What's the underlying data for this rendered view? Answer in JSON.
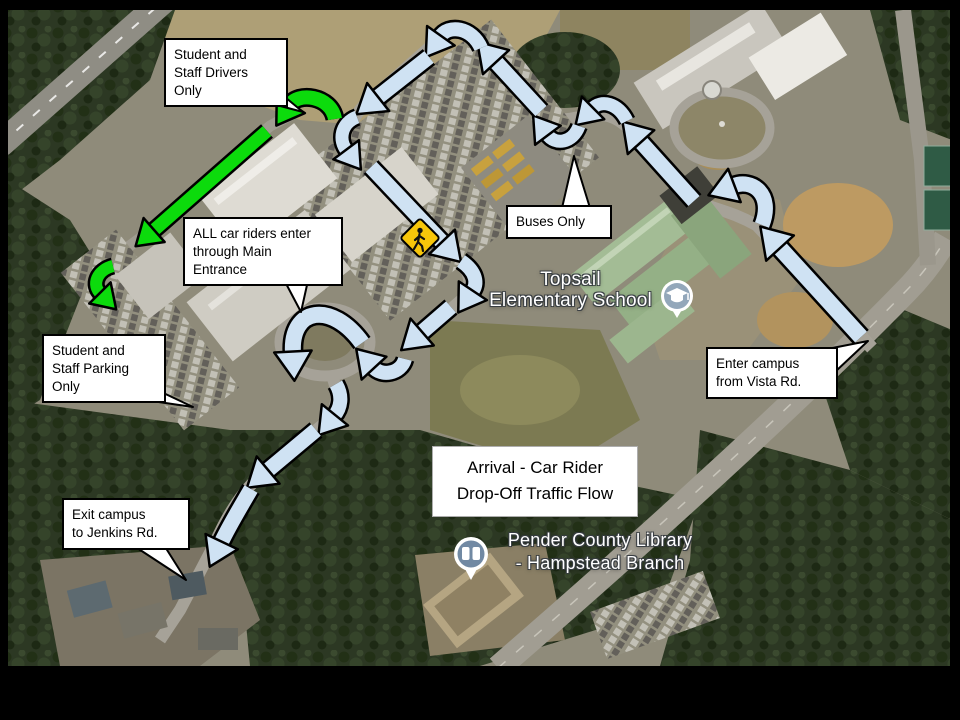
{
  "title": {
    "text": "Arrival - Car Rider\nDrop-Off Traffic Flow"
  },
  "callouts": {
    "drivers": {
      "text": "Student and\nStaff Drivers\nOnly"
    },
    "car_riders": {
      "text": "ALL car riders enter\nthrough Main\nEntrance"
    },
    "buses": {
      "text": "Buses Only"
    },
    "parking": {
      "text": "Student and\nStaff Parking\nOnly"
    },
    "enter": {
      "text": "Enter campus\nfrom Vista Rd."
    },
    "exit": {
      "text": "Exit campus\nto Jenkins Rd."
    }
  },
  "map_labels": {
    "school": {
      "text": "Topsail\nElementary School"
    },
    "library": {
      "text": "Pender County Library\n- Hampstead Branch"
    }
  },
  "icons": [
    {
      "name": "pedestrian-crossing-sign",
      "color": "#f7c60a"
    },
    {
      "name": "school-pin-icon"
    },
    {
      "name": "library-pin-icon"
    }
  ],
  "colors": {
    "car_route_fill": "#cfe2f3",
    "staff_route_fill": "#0cdb0c",
    "arrow_outline": "#000000",
    "sign_yellow": "#f7c60a",
    "frame": "#000000"
  },
  "flow_arrows": [
    {
      "name": "enter-from-vista-rd",
      "route": "car",
      "width": 16,
      "path": "M 861,337 L 779,247"
    },
    {
      "name": "entrance-turn-west",
      "route": "car",
      "width": 15,
      "path": "M 762,225 C 774,194 752,178 733,186"
    },
    {
      "name": "drive-northwest",
      "route": "car",
      "width": 15,
      "path": "M 694,201 L 640,141"
    },
    {
      "name": "bus-lane-curve-east",
      "route": "car",
      "width": 13,
      "path": "M 627,121 C 618,103 601,99 592,109"
    },
    {
      "name": "bus-lane-curve-west",
      "route": "car",
      "width": 13,
      "path": "M 579,126 C 573,143 555,146 547,134"
    },
    {
      "name": "north-lot-up",
      "route": "car",
      "width": 15,
      "path": "M 541,111 L 495,61"
    },
    {
      "name": "north-lot-u-turn",
      "route": "car",
      "width": 14,
      "path": "M 481,48 C 472,27 448,24 440,37"
    },
    {
      "name": "west-lot-down",
      "route": "car",
      "width": 15,
      "path": "M 429,57 L 377,98"
    },
    {
      "name": "west-corner-down",
      "route": "car",
      "width": 13,
      "path": "M 357,117 C 341,123 338,140 347,151"
    },
    {
      "name": "main-drive-southeast",
      "route": "car",
      "width": 15,
      "path": "M 371,167 L 443,243"
    },
    {
      "name": "main-drive-bend-south",
      "route": "car",
      "width": 14,
      "path": "M 461,261 C 477,272 478,284 472,292"
    },
    {
      "name": "front-drive-southwest",
      "route": "car",
      "width": 15,
      "path": "M 451,307 L 421,333"
    },
    {
      "name": "front-drive-turn-in",
      "route": "car",
      "width": 14,
      "path": "M 405,359 C 401,374 381,377 373,367"
    },
    {
      "name": "dropoff-loop",
      "route": "car",
      "width": 16,
      "path": "M 362,343 C 332,301 290,307 293,353"
    },
    {
      "name": "exit-bend-south",
      "route": "car",
      "width": 14,
      "path": "M 336,384 C 343,396 341,408 334,416"
    },
    {
      "name": "exit-southwest",
      "route": "car",
      "width": 15,
      "path": "M 316,430 L 267,471"
    },
    {
      "name": "exit-to-jenkins-rd",
      "route": "car",
      "width": 15,
      "path": "M 251,489 C 240,508 229,526 221,543"
    },
    {
      "name": "staff-entrance-turn",
      "route": "staff",
      "width": 14,
      "path": "M 335,119 C 331,95 297,92 290,105"
    },
    {
      "name": "staff-drive-southwest",
      "route": "staff",
      "width": 13,
      "path": "M 267,131 L 153,231"
    },
    {
      "name": "staff-parking-turn",
      "route": "staff",
      "width": 12,
      "path": "M 113,266 C 97,270 91,285 101,294"
    }
  ]
}
